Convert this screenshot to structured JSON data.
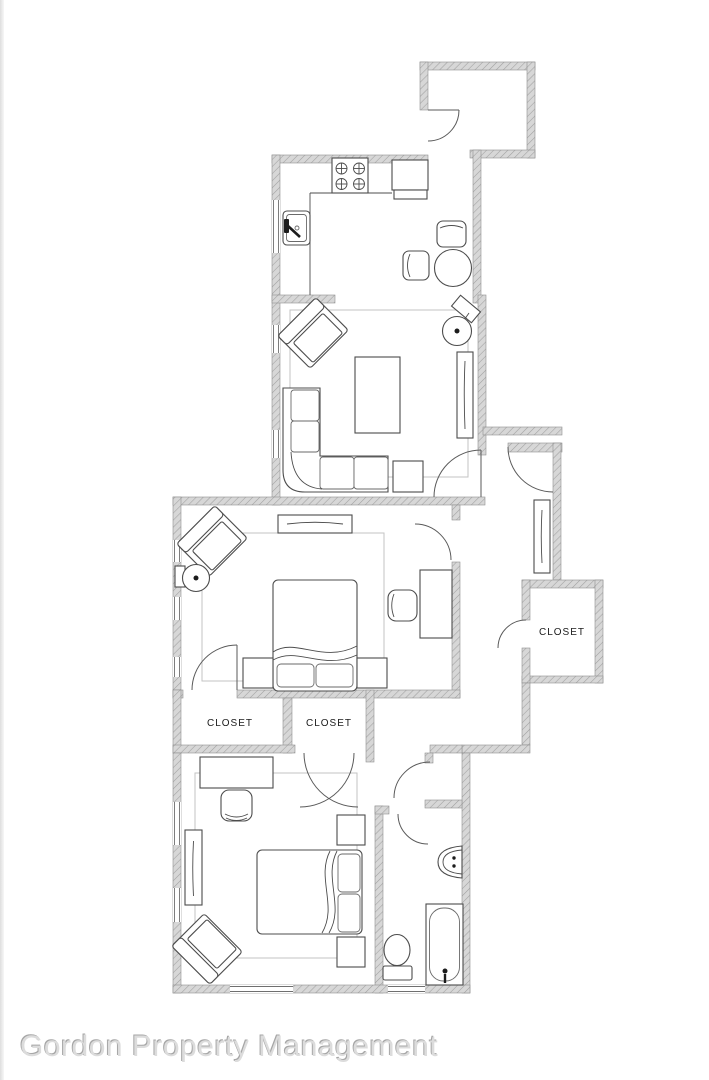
{
  "footer": {
    "title": "Gordon Property Management"
  },
  "plan": {
    "labels": {
      "closet_left": "CLOSET",
      "closet_right": "CLOSET",
      "closet_hall": "CLOSET"
    },
    "colors": {
      "wall_fill": "#d7d7d7",
      "wall_hatch": "#a0a0a0",
      "wall_edge": "#8f8f8f",
      "furniture_line": "#4c4c4c",
      "door_line": "#5a5a5a",
      "rug_line": "#c3c3c3",
      "label_text": "#1b1b1b",
      "footer_text": "#dcdcdc"
    }
  }
}
